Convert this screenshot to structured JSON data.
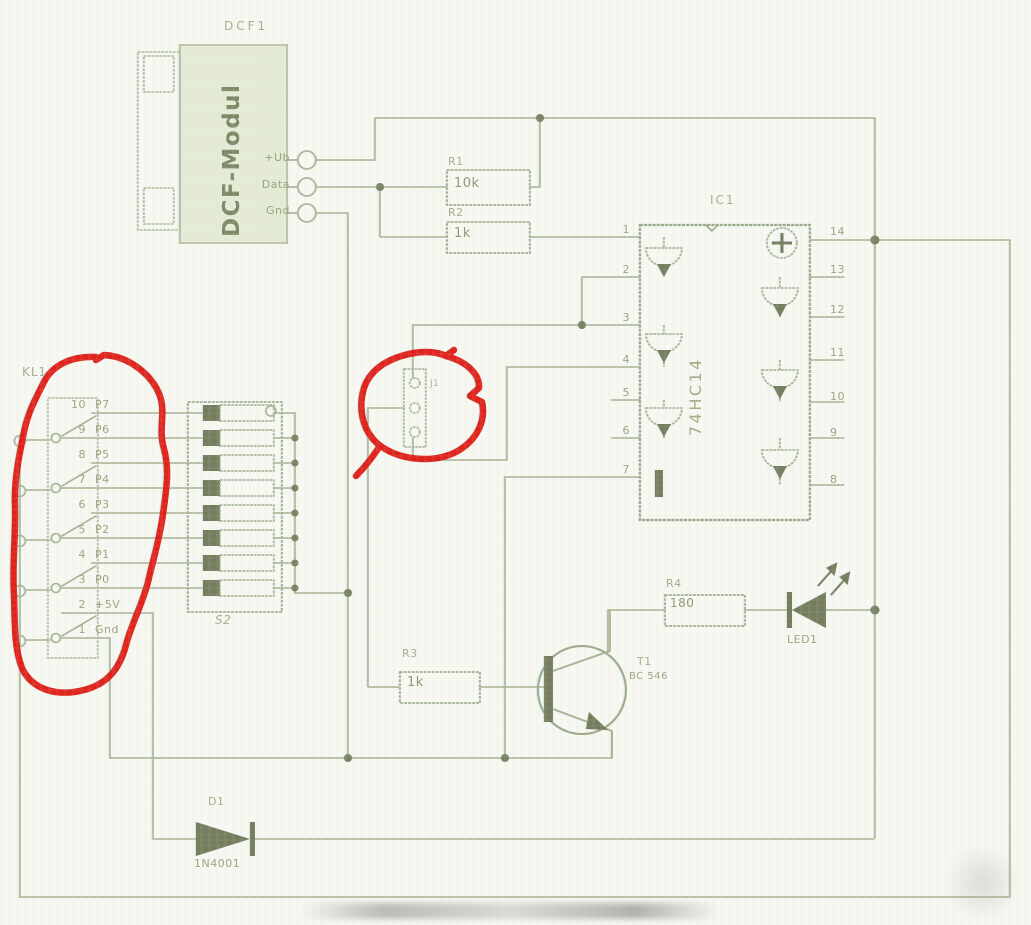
{
  "colors": {
    "paper": "#f7f8f2",
    "wire": "#a9b294",
    "dark_fill": "#757d5e",
    "label": "#99a37f",
    "module_fill": "#e5ebd6",
    "annotation_red": "#e0140f"
  },
  "dcf_module": {
    "ref": "DCF1",
    "name": "DCF-Modul",
    "pin_labels": [
      "+Ub",
      "Data",
      "Gnd"
    ]
  },
  "resistors": {
    "r1_ref": "R1",
    "r1_value": "10k",
    "r2_ref": "R2",
    "r2_value": "1k",
    "r3_ref": "R3",
    "r3_value": "1k",
    "r4_ref": "R4",
    "r4_value": "180"
  },
  "ic1": {
    "ref": "IC1",
    "part": "74HC14",
    "left_pins": [
      "1",
      "2",
      "3",
      "4",
      "5",
      "6",
      "7"
    ],
    "right_pins": [
      "14",
      "13",
      "12",
      "11",
      "10",
      "9",
      "8"
    ]
  },
  "kl1": {
    "ref": "KL1",
    "rows": [
      [
        "10",
        "P7"
      ],
      [
        "9",
        "P6"
      ],
      [
        "8",
        "P5"
      ],
      [
        "7",
        "P4"
      ],
      [
        "6",
        "P3"
      ],
      [
        "5",
        "P2"
      ],
      [
        "4",
        "P1"
      ],
      [
        "3",
        "P0"
      ],
      [
        "2",
        "+5V"
      ],
      [
        "1",
        "Gnd"
      ]
    ]
  },
  "dip_switch": {
    "ref": "S2"
  },
  "jumper": {
    "ref": "J1"
  },
  "transistor": {
    "ref": "T1",
    "part": "BC 546"
  },
  "led": {
    "ref": "LED1"
  },
  "diode": {
    "ref": "D1",
    "part": "1N4001"
  }
}
